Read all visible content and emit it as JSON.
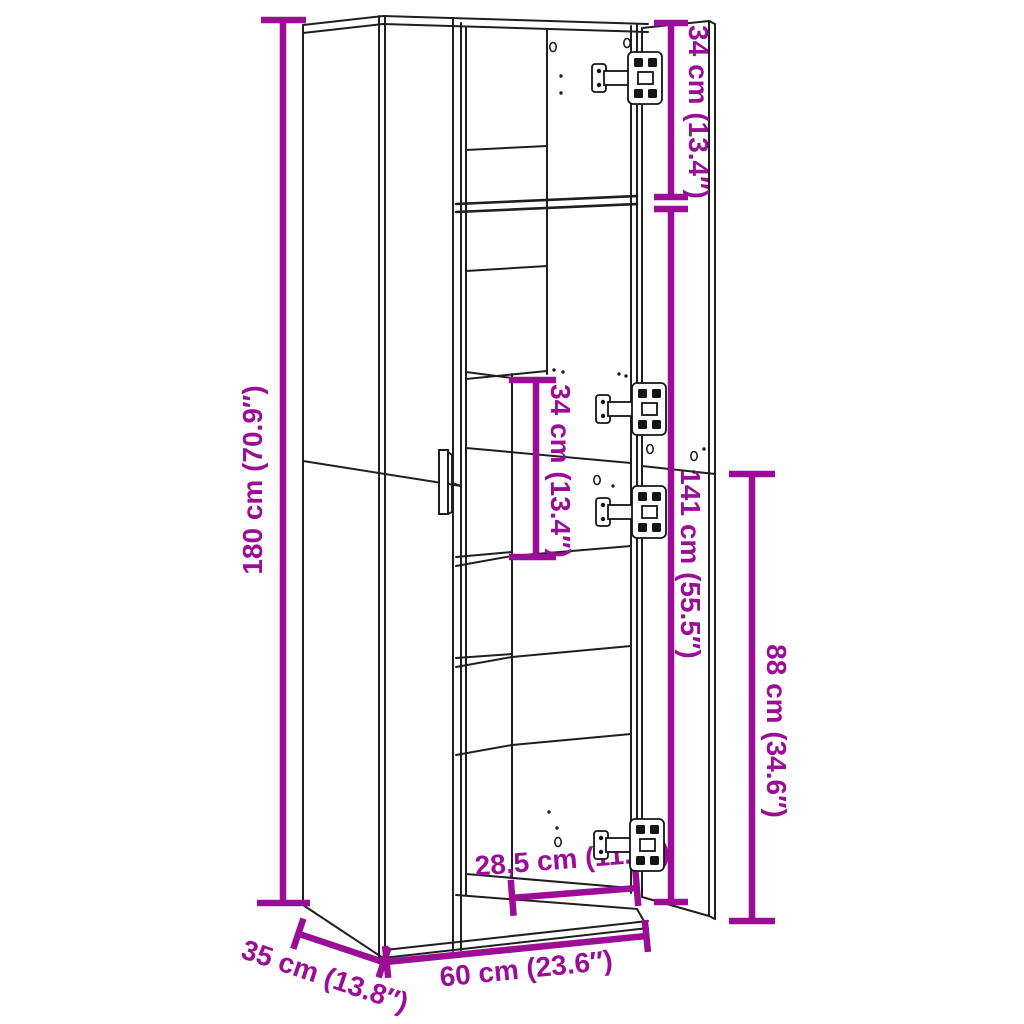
{
  "page": {
    "background": "#ffffff",
    "accent_color": "#9B0D96",
    "line_color": "#1f1f1f"
  },
  "diagram": {
    "type": "furniture-dimension-diagram",
    "subject": "tall two-door cabinet with open right door, interior shelves and cup hinges",
    "dimensions": {
      "total_height": "180 cm (70.9″)",
      "top_compartment_height": "34 cm (13.4″)",
      "door_height": "141 cm (55.5″)",
      "lower_section_height": "88 cm (34.6″)",
      "inner_compartment_height": "34 cm (13.4″)",
      "inner_compartment_width": "28,5 cm (11.2″)",
      "total_width": "60 cm (23.6″)",
      "total_depth": "35 cm (13.8″)"
    }
  }
}
